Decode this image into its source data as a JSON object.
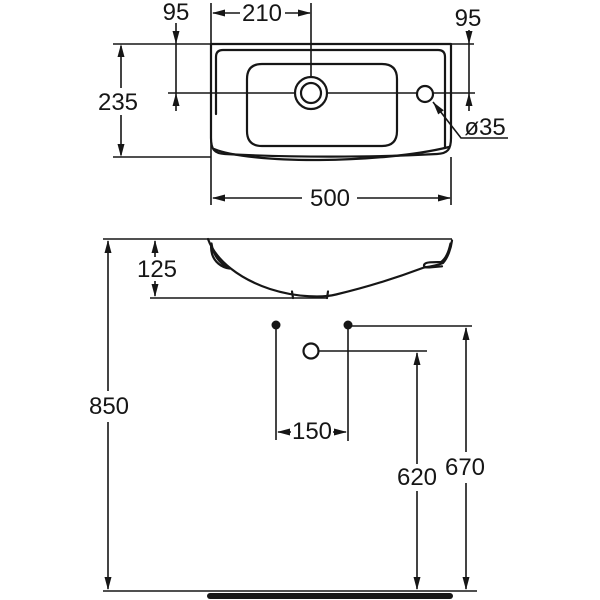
{
  "drawing": {
    "type": "technical-dimension-drawing",
    "subject": "wall-hung washbasin, top view and front elevation",
    "units": "mm",
    "colors": {
      "line": "#161616",
      "background": "#ffffff"
    },
    "top_view": {
      "labels": {
        "tap_setback": "95",
        "tap_offset": "210",
        "overflow_setback": "95",
        "depth": "235",
        "width": "500",
        "hole_diameter": "ø35"
      }
    },
    "front_view": {
      "labels": {
        "basin_height": "125",
        "rim_height": "850",
        "bolt_spacing": "150",
        "drain_height": "620",
        "bolt_height": "670"
      }
    }
  }
}
